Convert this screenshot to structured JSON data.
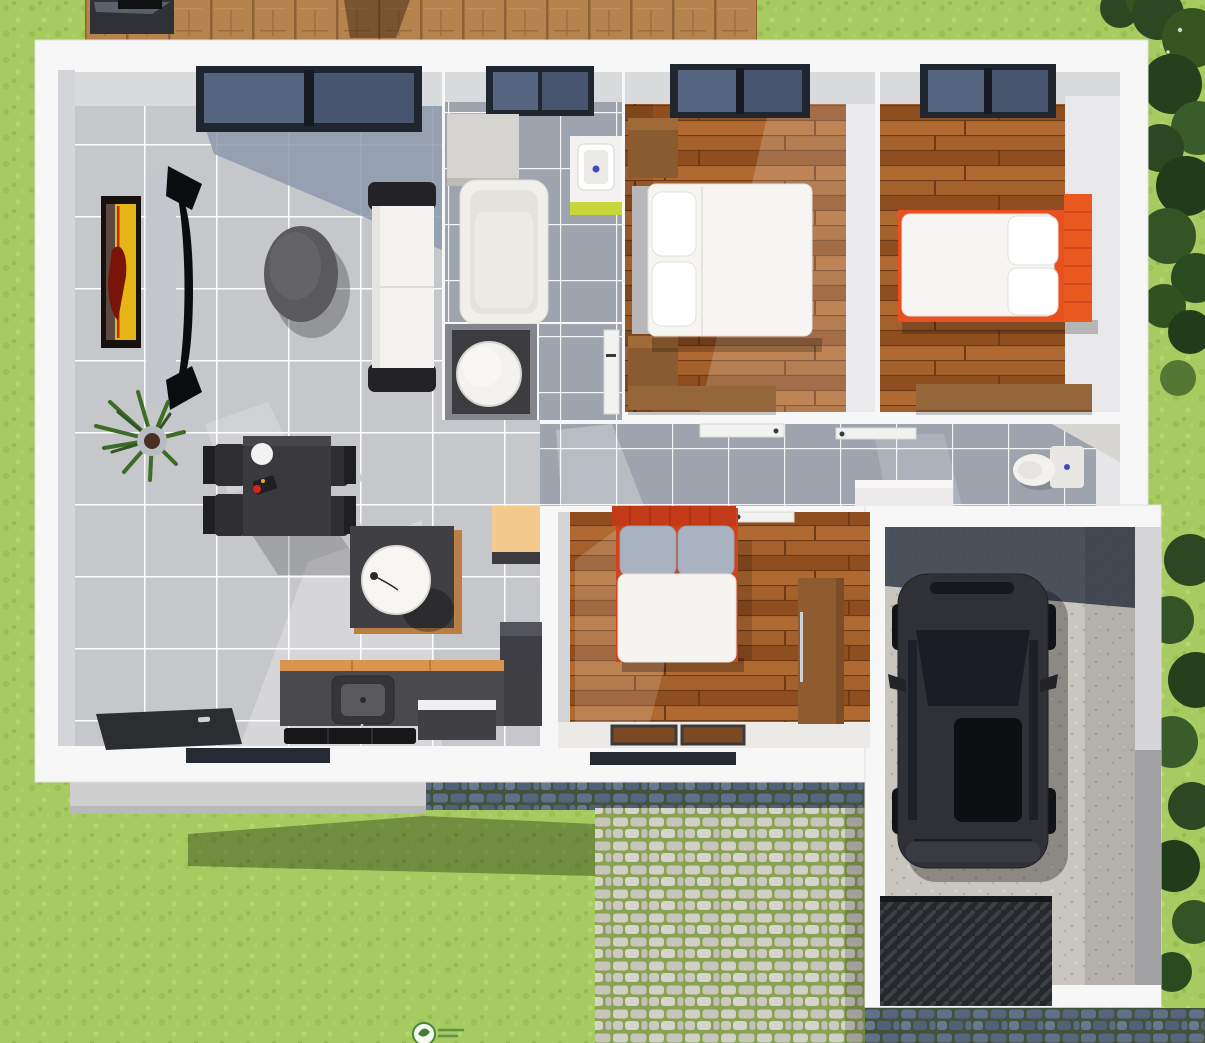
{
  "scene": {
    "view": "top-down-3d-house-floor-plan-render",
    "rooms": [
      "living-room",
      "dining-area",
      "kitchen",
      "bathroom",
      "utility-closet",
      "hallway",
      "bedroom-1",
      "bedroom-2",
      "bedroom-3",
      "wc",
      "garage"
    ],
    "exterior": [
      "lawn",
      "wood-deck",
      "patio-furniture",
      "hedge-trees",
      "porch-step",
      "cobblestone-driveway",
      "house-shadow",
      "watermark-logo"
    ],
    "objects": {
      "living-room": [
        "wall-art",
        "tv-panel",
        "curved-tv",
        "floor-plant",
        "round-coffee-table",
        "white-sofa",
        "dining-table",
        "dining-chairs-x4",
        "dinner-plate",
        "table-centerpiece",
        "side-table",
        "sphere-lamp",
        "front-door",
        "picture-window"
      ],
      "kitchen": [
        "counter",
        "sink",
        "faucet",
        "cooktop",
        "dishwasher",
        "fridge",
        "peach-cabinet"
      ],
      "bathroom": [
        "bathtub",
        "washbasin",
        "corner-cabinet",
        "window"
      ],
      "utility-closet": [
        "water-heater-cylinder",
        "door"
      ],
      "bedroom-1": [
        "double-bed-white",
        "pillows-x2",
        "gray-headboard",
        "nightstand-x2",
        "desk",
        "window"
      ],
      "bedroom-2": [
        "double-bed-orange",
        "pillows-x2",
        "orange-headboard",
        "desk",
        "window"
      ],
      "bedroom-3": [
        "double-bed-red",
        "gray-pillows-x2",
        "wardrobe",
        "rugs-x2",
        "door"
      ],
      "wc": [
        "toilet",
        "corner-shelf"
      ],
      "hallway": [
        "open-doors-x2",
        "white-cabinet"
      ],
      "garage": [
        "black-car",
        "side-mirrors",
        "sunroof",
        "ribbed-ramp"
      ]
    }
  },
  "palette": {
    "grass": "#a7cb61",
    "deck": "#b5834e",
    "wall": "#f7f7f7",
    "wallFace": "#d9dadc",
    "wallFaceGray": "#d4d5d8",
    "wallFaceBright": "#ebebed",
    "shadowBlue": "#8c99ad",
    "windowFrame": "#20262f",
    "glassA": "#55657f",
    "glassB": "#47566e",
    "artFrame": "#17120e",
    "artYellow": "#e5b517",
    "artRed": "#7a1408",
    "tvPanel": "#c3c7cd",
    "tvBlack": "#0b0c0e",
    "coffeeTable": "#5a5a5e",
    "sofaWhite": "#f4f3f0",
    "sofaArm": "#232327",
    "plantGreen": "#3e6b26",
    "potGray": "#b9bdc3",
    "tableDark": "#3a3a3e",
    "chairSeat": "#2e2e33",
    "chairBack": "#1f1f23",
    "chrome": "#c6c9cd",
    "plate": "#f2f2f0",
    "fruitRed": "#d42415",
    "lampTable": "#3f3f44",
    "lampWood": "#b97f45",
    "lampSphere": "#f7f6f3",
    "counter": "#4a4a4e",
    "counterTop": "#d9954f",
    "sinkDark": "#36363a",
    "cooktop": "#17171a",
    "appliance": "#3f3f44",
    "applianceTop": "#eef0f2",
    "fridge": "#3e3e44",
    "doorDark": "#2b2d30",
    "doorLeaf": "#f2f2f0",
    "handle": "#cfd2d6",
    "cabinetPeach": "#f4c98c",
    "tub": "#f1efec",
    "tubInner": "#e4e2dd",
    "bathCab": "#d6d4d0",
    "basin": "#ffffff",
    "lime": "#c8d53b",
    "drainBlue": "#3a4ec2",
    "heater": "#f3f2ee",
    "closetDark": "#313136",
    "nightstand": "#8a5a30",
    "desk": "#96663b",
    "mattress": "#f6f5f2",
    "pillow": "#ffffff",
    "headboardGray": "#b9b9bb",
    "bedOrange": "#e8501f",
    "headboardOrange": "#ea5a20",
    "bedRed": "#d0431c",
    "headboardRed": "#c23a18",
    "pillowGray": "#aab3c2",
    "duvet": "#f5f4f1",
    "wardrobe": "#8f5c30",
    "rug": "#7c4a22",
    "hallCabinet": "#eceaea",
    "toilet": "#f2f1ee",
    "toiletTank": "#e8e7e3",
    "shelf": "#d8d6d2",
    "garageWallTop": "#d6d6d8",
    "garageWallBottom": "#a2a2a4",
    "garageShadow": "#323c49",
    "carBody": "#303136",
    "carGlass": "#1a1d24",
    "carRoof": "#0e0f12",
    "carDetail": "#17181b",
    "mirror": "#232428",
    "wheel": "#121316",
    "porch": "#cfcfcf",
    "porchEdge": "#b9b9ba",
    "bottomWindow": "#262b33",
    "patio": "#2e3237",
    "watermark": "#3f7d3a"
  }
}
